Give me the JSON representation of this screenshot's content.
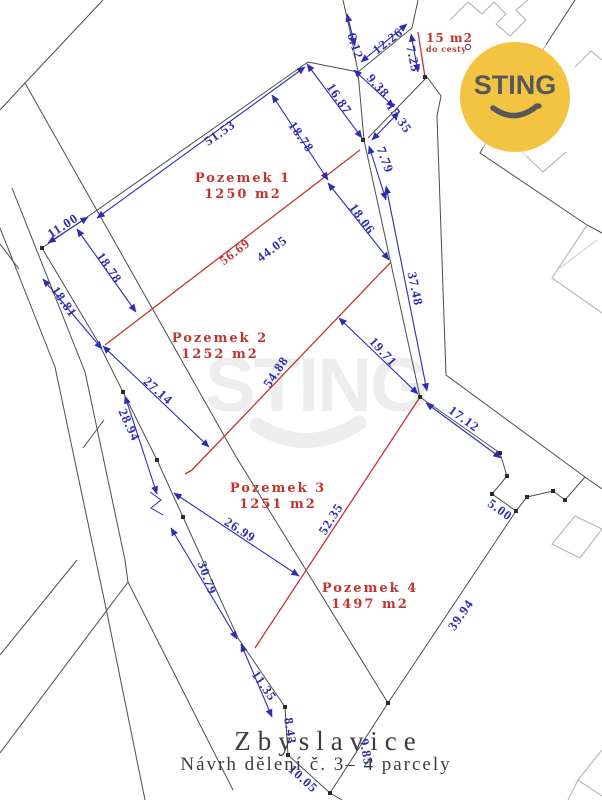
{
  "map": {
    "title": "Zbyslavice",
    "subtitle": "Návrh dělení č. 3– 4 parcely",
    "logo_text": "STING",
    "watermark_text": "STING",
    "road_note": {
      "line1": "15 m2",
      "line2": "do cesty",
      "x": 426,
      "y": 32
    },
    "colors": {
      "dimension_blue": "#2d2db0",
      "division_red": "#c13531",
      "boundary_gray": "#4d4d4d",
      "logo_yellow": "#f3c441"
    },
    "parcels": [
      {
        "name": "Pozemek 1",
        "area": "1250 m2",
        "x": 243,
        "y": 187
      },
      {
        "name": "Pozemek 2",
        "area": "1252 m2",
        "x": 220,
        "y": 347
      },
      {
        "name": "Pozemek 3",
        "area": "1251 m2",
        "x": 278,
        "y": 497
      },
      {
        "name": "Pozemek 4",
        "area": "1497 m2",
        "x": 370,
        "y": 597
      }
    ],
    "measurements": [
      {
        "v": "6.12",
        "x": 355,
        "y": 46,
        "r": 72,
        "c": "blue"
      },
      {
        "v": "12.26",
        "x": 388,
        "y": 41,
        "r": -38,
        "c": "blue"
      },
      {
        "v": "7.25",
        "x": 413,
        "y": 59,
        "r": 78,
        "c": "blue"
      },
      {
        "v": "9.38",
        "x": 378,
        "y": 86,
        "r": 48,
        "c": "blue"
      },
      {
        "v": "16.87",
        "x": 339,
        "y": 99,
        "r": 56,
        "c": "blue"
      },
      {
        "v": "15.35",
        "x": 399,
        "y": 118,
        "r": 55,
        "c": "blue"
      },
      {
        "v": "18.78",
        "x": 301,
        "y": 137,
        "r": 55,
        "c": "blue"
      },
      {
        "v": "51.53",
        "x": 220,
        "y": 133,
        "r": -35,
        "c": "blue"
      },
      {
        "v": "7.79",
        "x": 385,
        "y": 160,
        "r": 70,
        "c": "blue"
      },
      {
        "v": "18.06",
        "x": 362,
        "y": 219,
        "r": 54,
        "c": "blue"
      },
      {
        "v": "11.00",
        "x": 63,
        "y": 226,
        "r": -33,
        "c": "blue"
      },
      {
        "v": "18.78",
        "x": 109,
        "y": 268,
        "r": 55,
        "c": "blue"
      },
      {
        "v": "18.81",
        "x": 64,
        "y": 302,
        "r": 55,
        "c": "blue"
      },
      {
        "v": "56.69",
        "x": 235,
        "y": 252,
        "r": -37,
        "c": "red"
      },
      {
        "v": "44.05",
        "x": 272,
        "y": 249,
        "r": -37,
        "c": "blue"
      },
      {
        "v": "37.48",
        "x": 415,
        "y": 289,
        "r": 78,
        "c": "blue"
      },
      {
        "v": "27.14",
        "x": 158,
        "y": 391,
        "r": 42,
        "c": "blue"
      },
      {
        "v": "28.94",
        "x": 129,
        "y": 425,
        "r": 65,
        "c": "blue"
      },
      {
        "v": "54.88",
        "x": 276,
        "y": 372,
        "r": -56,
        "c": "blue"
      },
      {
        "v": "19.71",
        "x": 383,
        "y": 352,
        "r": 48,
        "c": "blue"
      },
      {
        "v": "17.12",
        "x": 464,
        "y": 419,
        "r": 36,
        "c": "blue"
      },
      {
        "v": "26.99",
        "x": 240,
        "y": 530,
        "r": 33,
        "c": "blue"
      },
      {
        "v": "52.35",
        "x": 331,
        "y": 519,
        "r": -58,
        "c": "blue"
      },
      {
        "v": "5.00",
        "x": 500,
        "y": 510,
        "r": 36,
        "c": "blue"
      },
      {
        "v": "30.79",
        "x": 207,
        "y": 578,
        "r": 70,
        "c": "blue"
      },
      {
        "v": "39.94",
        "x": 461,
        "y": 615,
        "r": -55,
        "c": "blue"
      },
      {
        "v": "11.35",
        "x": 264,
        "y": 686,
        "r": 55,
        "c": "blue"
      },
      {
        "v": "8.43",
        "x": 290,
        "y": 731,
        "r": 82,
        "c": "blue"
      },
      {
        "v": "9.85",
        "x": 366,
        "y": 752,
        "r": 80,
        "c": "blue"
      },
      {
        "v": "10.05",
        "x": 303,
        "y": 779,
        "r": 42,
        "c": "blue"
      }
    ]
  }
}
